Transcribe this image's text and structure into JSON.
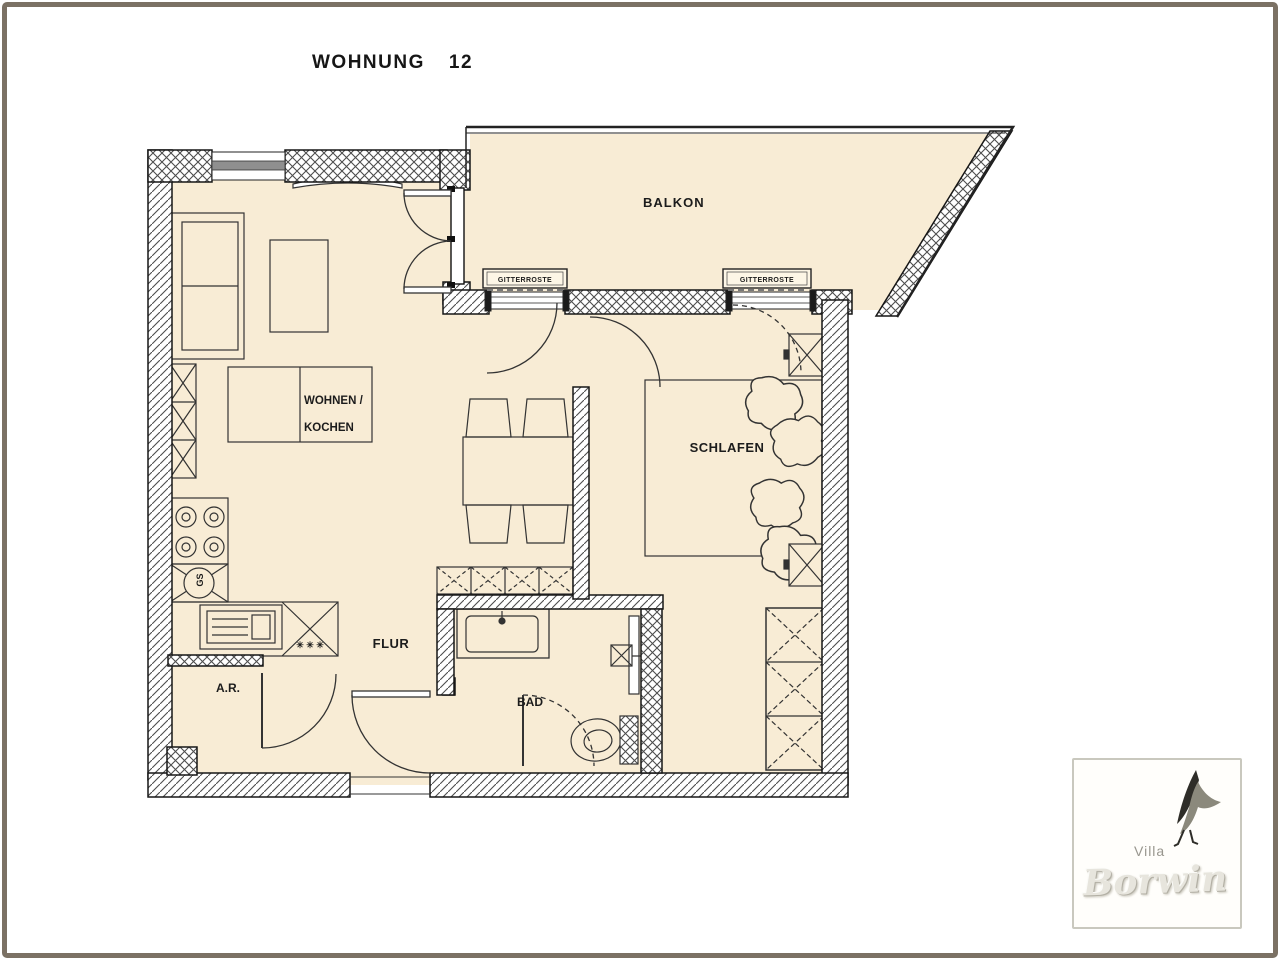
{
  "title": {
    "word": "WOHNUNG",
    "number": "12"
  },
  "rooms": {
    "balkon": "BALKON",
    "wohnen_kochen_line1": "WOHNEN /",
    "wohnen_kochen_line2": "KOCHEN",
    "schlafen": "SCHLAFEN",
    "flur": "FLUR",
    "bad": "BAD",
    "abstellraum": "A.R."
  },
  "annotations": {
    "grating": "GITTERROSTE",
    "dishwasher": "GS",
    "hob_symbol": "✳ ✳ ✳"
  },
  "colors": {
    "floor": "#f8ecd5",
    "line": "#2a2a2a",
    "glazing": "#8f8f8f",
    "frame_border": "#7b7164"
  },
  "logo": {
    "prefix": "Villa",
    "name": "Borwin"
  }
}
